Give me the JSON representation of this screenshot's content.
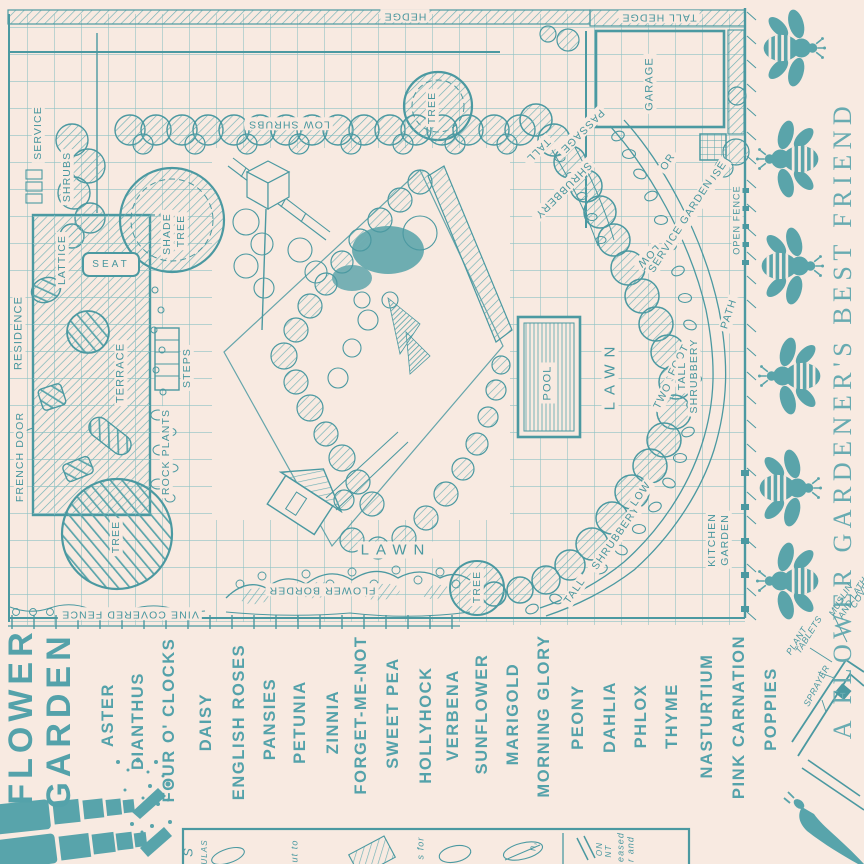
{
  "colors": {
    "background": "#f8eae1",
    "ink": "#5aa4aa",
    "ink_bold": "#4b99a1",
    "grid": "#8ec2c4"
  },
  "plan": {
    "labels": {
      "hedge": "HEDGE",
      "tall_hedge": "TALL HEDGE",
      "low_shrubs": "LOW SHRUBS",
      "service": "SERVICE",
      "shrubs": "SHRUBS",
      "shade": "SHADE",
      "shade_tree": "TREE",
      "lattice": "LATTICE",
      "seat": "SEAT",
      "residence": "RESIDENCE",
      "terrace": "TERRACE",
      "steps": "STEPS",
      "rock_plants": "ROCK PLANTS",
      "french_door": "FRENCH DOOR",
      "tree_top": "TREE",
      "tree_left": "TREE",
      "tree_bottom": "TREE",
      "garage": "GARAGE",
      "passage": "PASSAGE",
      "tall_upper": "TALL",
      "shrubbery_upper": "SHRUBBERY",
      "low_upper": "LOW",
      "greenhouse_line1": "GREEN HOUSE",
      "greenhouse_line2": "OR",
      "greenhouse_line3": "SERVICE GARDEN",
      "open_fence": "OPEN FENCE",
      "path": "PATH",
      "two": "TWO",
      "foot": "FOOT",
      "tall_right": "TALL",
      "shrubbery_right": "SHRUBBERY",
      "pool": "POOL",
      "lawn_vertical": "LAWN",
      "lawn_horizontal": "LAWN",
      "flower_border": "FLOWER BORDER",
      "vine_covered_fence": "VINE COVERED FENCE",
      "tall_lower": "TALL",
      "shrubbery_lower": "SHRUBBERY",
      "low_lower": "LOW",
      "kitchen": "KITCHEN",
      "kitchen_garden": "GARDEN"
    }
  },
  "title": {
    "word1": "FLOWER",
    "word2": "GARDEN"
  },
  "flowers": [
    "ASTER",
    "DIANTHUS",
    "FOUR O' CLOCKS",
    "DAISY",
    "ENGLISH ROSES",
    "PANSIES",
    "PETUNIA",
    "ZINNIA",
    "FORGET-ME-NOT",
    "SWEET PEA",
    "HOLLYHOCK",
    "VERBENA",
    "SUNFLOWER",
    "MARIGOLD",
    "MORNING GLORY",
    "PEONY",
    "DAHLIA",
    "PHLOX",
    "THYME",
    "NASTURTIUM",
    "PINK CARNATION",
    "POPPIES"
  ],
  "tagline": "A FLOWER GARDENER'S BEST FRIEND",
  "equipment": {
    "sprayer": "SPRAYER",
    "plant": "PLANT",
    "tablets": "TABLETS",
    "muslin": "MUSLIN",
    "and_lath": "AND LATH",
    "cover": "COVER"
  },
  "info_box_fragments": [
    "S",
    "ULAS",
    "ut to",
    "s for",
    "n,",
    "ON",
    "NT",
    "eased",
    "r and"
  ]
}
